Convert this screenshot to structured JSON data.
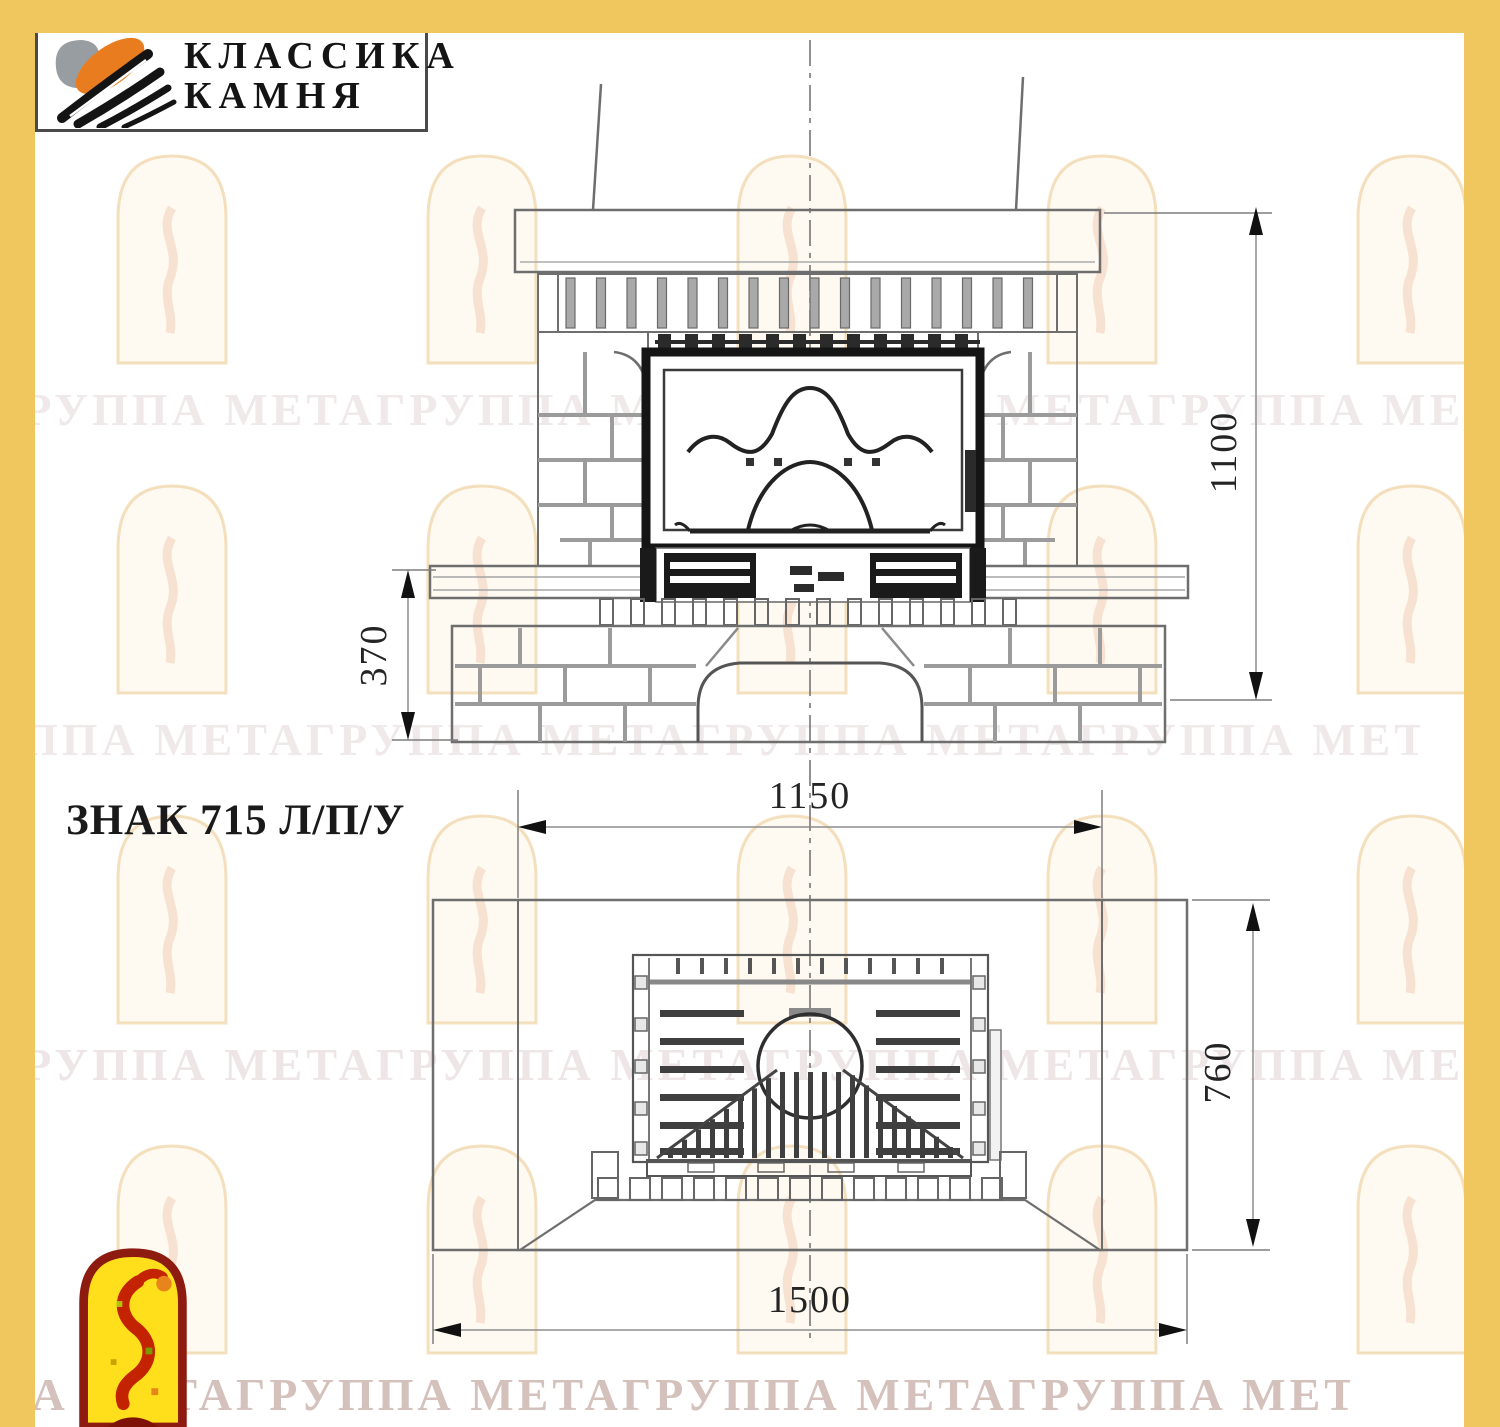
{
  "header_logo": {
    "line1": "КЛАССИКА",
    "line2": "КАМНЯ",
    "icon": "stone-classic-logo",
    "colors": {
      "gray": "#989da1",
      "orange": "#e87c1f",
      "black": "#141414"
    }
  },
  "model_label": "ЗНАК 715 Л/П/У",
  "dims": {
    "front_height": "1100",
    "hearth_height": "370",
    "niche_width": "1150",
    "depth": "760",
    "total_width": "1500"
  },
  "views": {
    "front": {
      "label": "front-elevation",
      "dimensions": [
        "1100",
        "370",
        "1150"
      ]
    },
    "plan": {
      "label": "top-plan-view",
      "dimensions": [
        "760",
        "1500"
      ]
    }
  },
  "watermark": {
    "text": "ГРУППА МЕТАГРУППА МЕТАГРУППА МЕТАГРУППА МЕТАГРУППА МЕТА",
    "rows": 4
  },
  "frame": {
    "border_color": "#efc75e"
  },
  "footer_logo": {
    "icon": "meta-arch-logo",
    "colors": {
      "border": "#8e1b10",
      "fill": "#ffdf1c",
      "figure": "#c32300"
    }
  }
}
